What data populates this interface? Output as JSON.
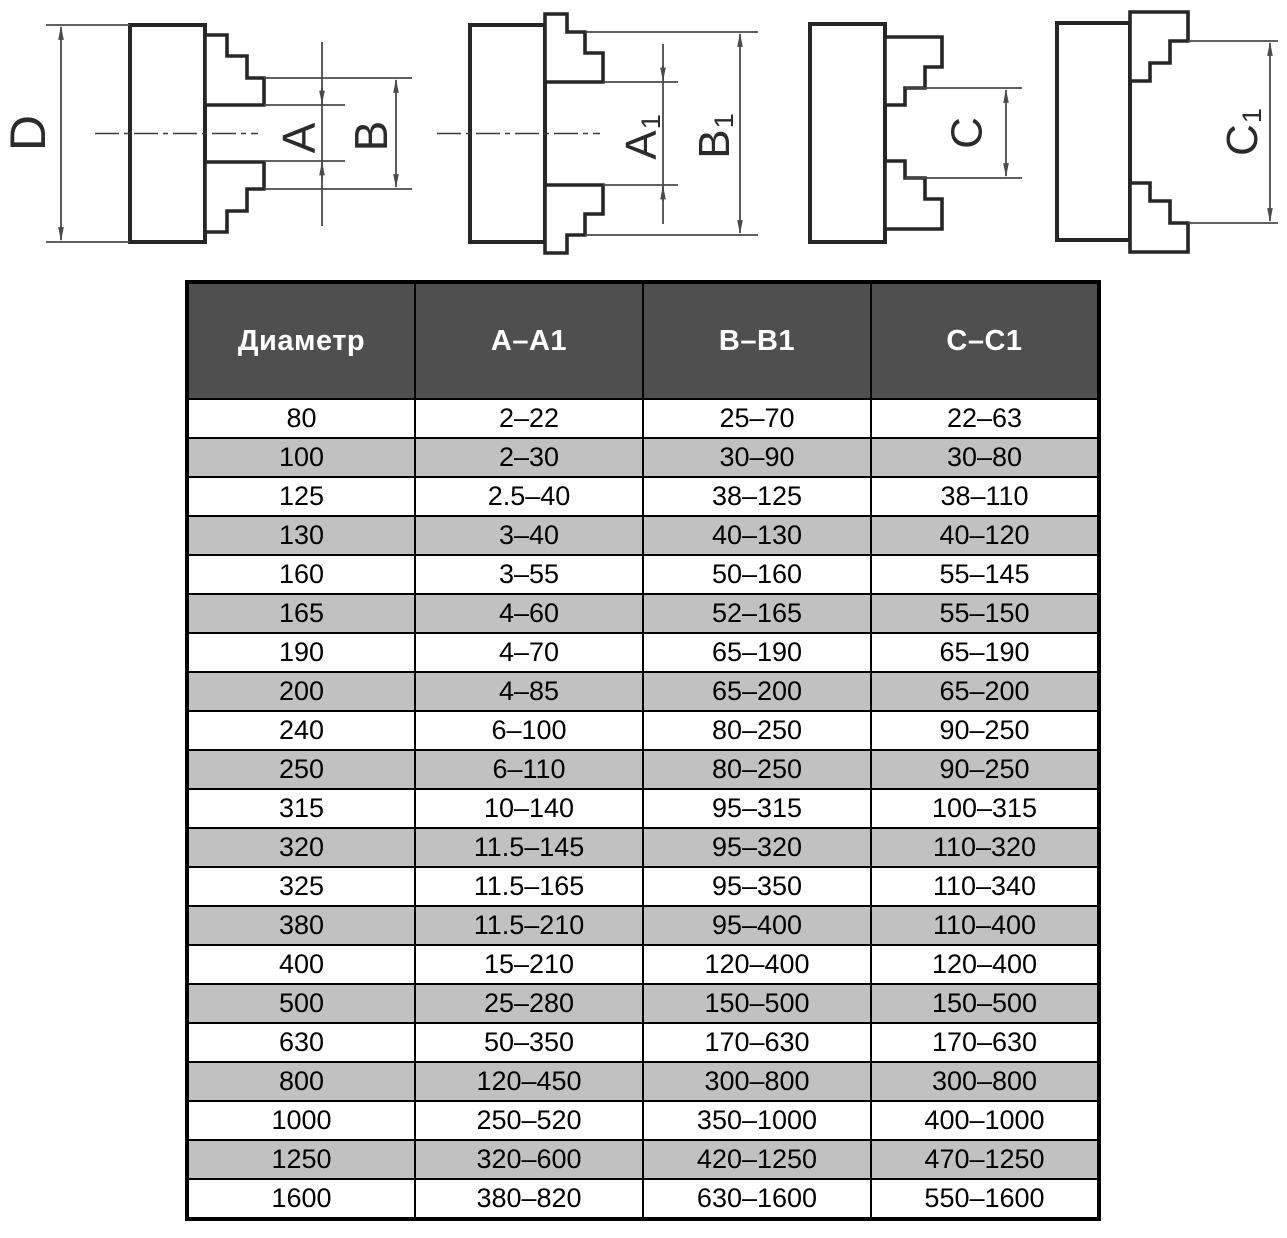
{
  "figures": {
    "fig1": {
      "label_d": "D",
      "label_a": "A",
      "label_b": "B"
    },
    "fig2": {
      "label_a_main": "A",
      "label_a_sub": "1",
      "label_b_main": "B",
      "label_b_sub": "1"
    },
    "fig3": {
      "label_c": "C"
    },
    "fig4": {
      "label_c_main": "C",
      "label_c_sub": "1"
    }
  },
  "table": {
    "headers": [
      "Диаметр",
      "A–A1",
      "B–B1",
      "C–C1"
    ],
    "rows": [
      [
        "80",
        "2–22",
        "25–70",
        "22–63"
      ],
      [
        "100",
        "2–30",
        "30–90",
        "30–80"
      ],
      [
        "125",
        "2.5–40",
        "38–125",
        "38–110"
      ],
      [
        "130",
        "3–40",
        "40–130",
        "40–120"
      ],
      [
        "160",
        "3–55",
        "50–160",
        "55–145"
      ],
      [
        "165",
        "4–60",
        "52–165",
        "55–150"
      ],
      [
        "190",
        "4–70",
        "65–190",
        "65–190"
      ],
      [
        "200",
        "4–85",
        "65–200",
        "65–200"
      ],
      [
        "240",
        "6–100",
        "80–250",
        "90–250"
      ],
      [
        "250",
        "6–110",
        "80–250",
        "90–250"
      ],
      [
        "315",
        "10–140",
        "95–315",
        "100–315"
      ],
      [
        "320",
        "11.5–145",
        "95–320",
        "110–320"
      ],
      [
        "325",
        "11.5–165",
        "95–350",
        "110–340"
      ],
      [
        "380",
        "11.5–210",
        "95–400",
        "110–400"
      ],
      [
        "400",
        "15–210",
        "120–400",
        "120–400"
      ],
      [
        "500",
        "25–280",
        "150–500",
        "150–500"
      ],
      [
        "630",
        "50–350",
        "170–630",
        "170–630"
      ],
      [
        "800",
        "120–450",
        "300–800",
        "300–800"
      ],
      [
        "1000",
        "250–520",
        "350–1000",
        "400–1000"
      ],
      [
        "1250",
        "320–600",
        "420–1250",
        "470–1250"
      ],
      [
        "1600",
        "380–820",
        "630–1600",
        "550–1600"
      ]
    ]
  },
  "colors": {
    "header_bg": "#4f4f4f",
    "header_text": "#ffffff",
    "alt_row_bg": "#c1c1c1",
    "table_border": "#000000",
    "outline": "#262626",
    "dim_line": "#4a4a4a",
    "label": "#2b2b2b",
    "page_bg": "#ffffff"
  }
}
